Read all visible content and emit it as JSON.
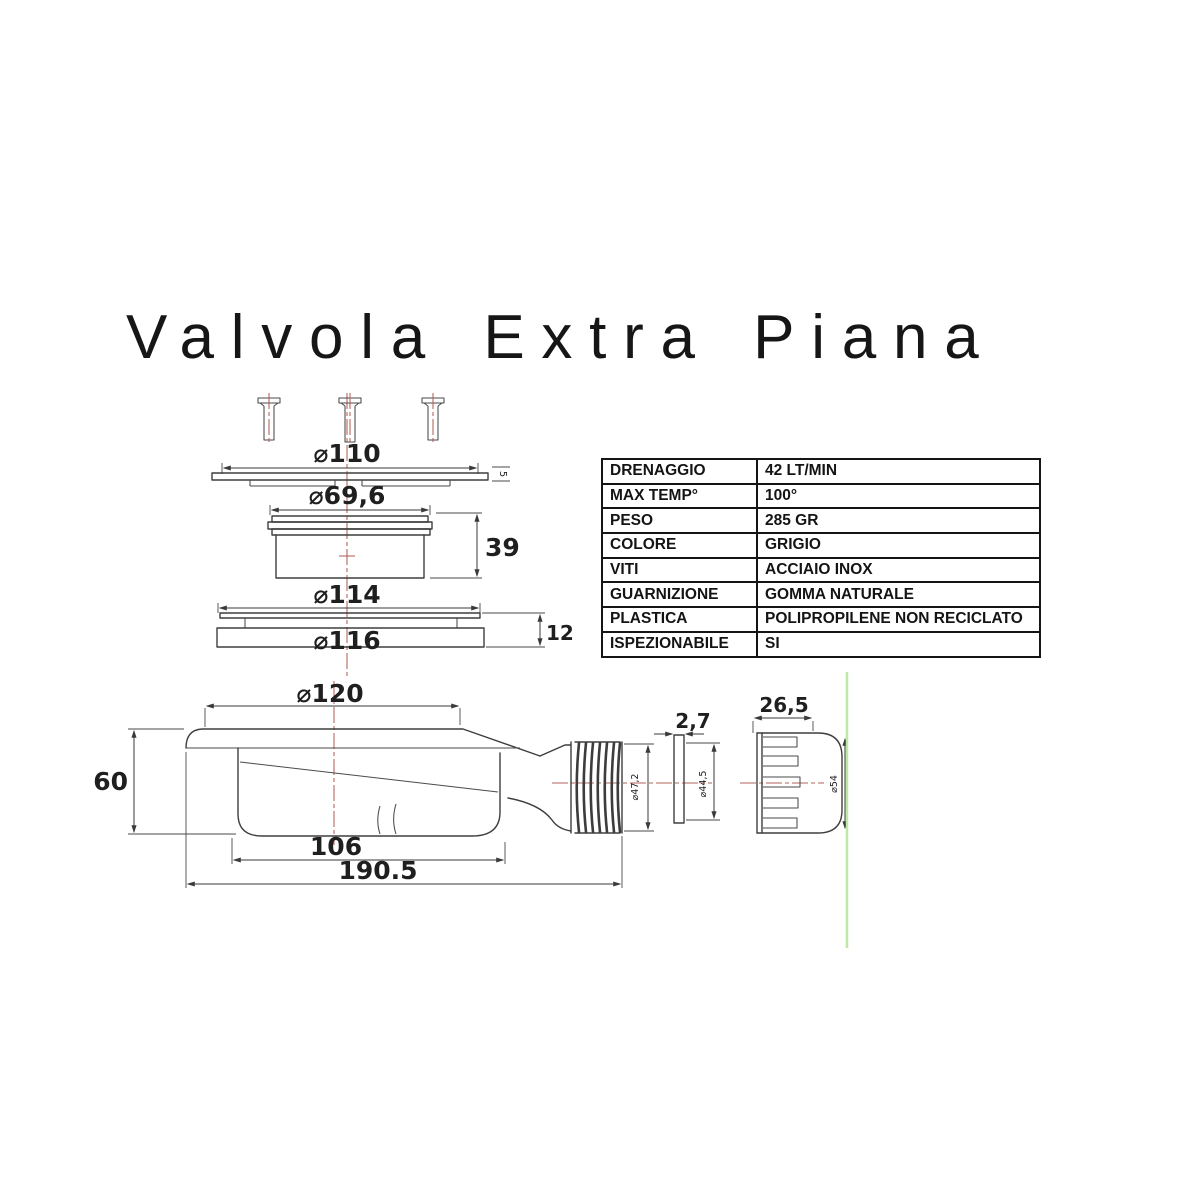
{
  "title": "Valvola Extra Piana",
  "spec_table": {
    "rows": [
      {
        "label": "DRENAGGIO",
        "value": "42 LT/MIN"
      },
      {
        "label": "MAX TEMP°",
        "value": "100°"
      },
      {
        "label": "PESO",
        "value": "285 GR"
      },
      {
        "label": "COLORE",
        "value": "GRIGIO"
      },
      {
        "label": "VITI",
        "value": "ACCIAIO INOX"
      },
      {
        "label": "GUARNIZIONE",
        "value": "GOMMA NATURALE"
      },
      {
        "label": "PLASTICA",
        "value": "POLIPROPILENE NON RECICLATO"
      },
      {
        "label": "ISPEZIONABILE",
        "value": "SI"
      }
    ]
  },
  "dimensions": {
    "cover_diameter": "⌀110",
    "cover_thickness": "5",
    "insert_diameter": "⌀69,6",
    "insert_height": "39",
    "flange_top_diameter": "⌀114",
    "flange_assembly_height": "12",
    "flange_bottom_diameter": "⌀116",
    "body_diameter": "⌀120",
    "body_height": "60",
    "sump_length": "106",
    "total_length": "190.5",
    "outlet_diameter": "⌀47,2",
    "gasket_thickness": "2,7",
    "gasket_diameter": "⌀44,5",
    "nut_length": "26,5",
    "nut_diameter": "⌀54"
  },
  "colors": {
    "line": "#3e3e3e",
    "centerline_red": "#b26158",
    "accent_green": "#bfe7a6",
    "table_border": "#151515",
    "text": "#161616",
    "background": "#ffffff"
  }
}
